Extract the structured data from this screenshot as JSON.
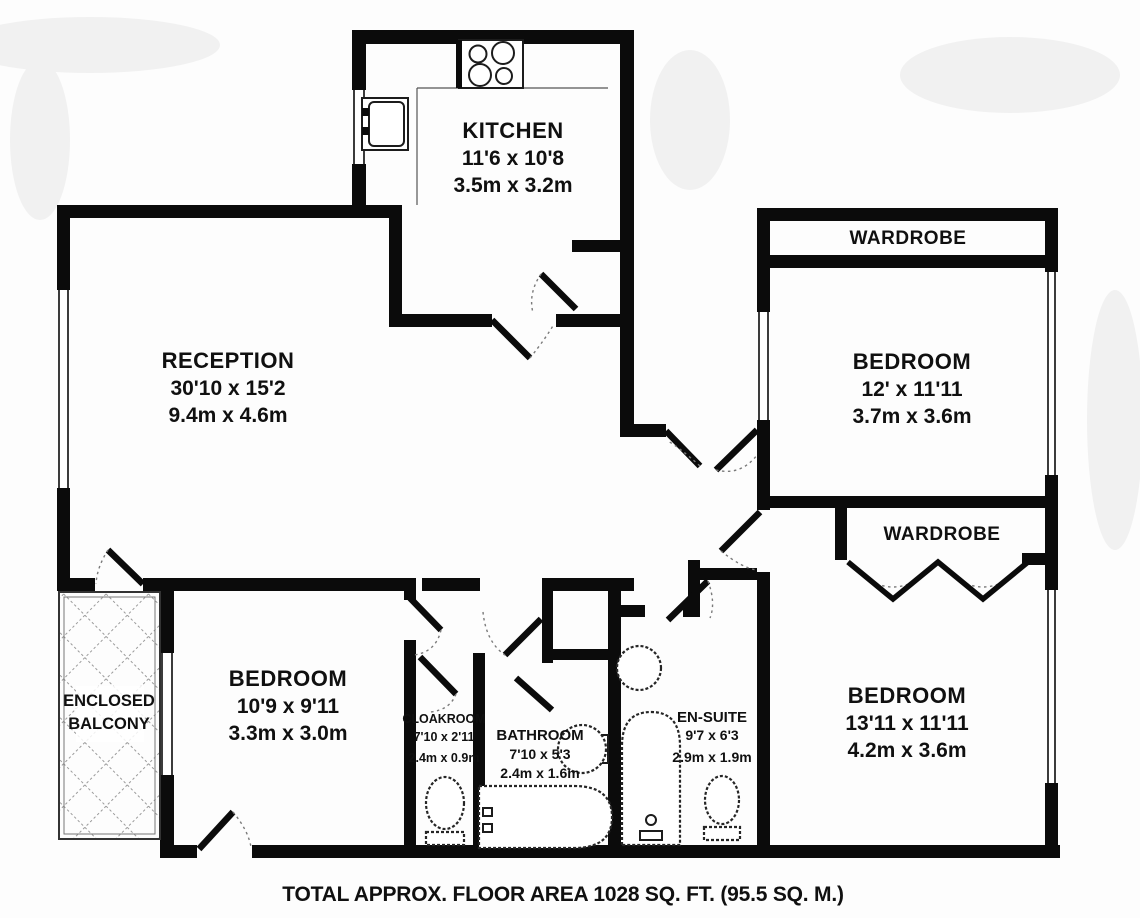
{
  "plan": {
    "caption": "TOTAL APPROX. FLOOR AREA 1028 SQ. FT. (95.5 SQ. M.)",
    "rooms": {
      "reception": {
        "name": "RECEPTION",
        "imperial": "30'10 x 15'2",
        "metric": "9.4m x 4.6m"
      },
      "kitchen": {
        "name": "KITCHEN",
        "imperial": "11'6 x 10'8",
        "metric": "3.5m x 3.2m"
      },
      "bedroom_top_right": {
        "name": "BEDROOM",
        "imperial": "12' x 11'11",
        "metric": "3.7m x 3.6m"
      },
      "bedroom_bottom_right": {
        "name": "BEDROOM",
        "imperial": "13'11 x 11'11",
        "metric": "4.2m x 3.6m"
      },
      "bedroom_bottom_left": {
        "name": "BEDROOM",
        "imperial": "10'9 x 9'11",
        "metric": "3.3m x 3.0m"
      },
      "bathroom": {
        "name": "BATHROOM",
        "imperial": "7'10 x 5'3",
        "metric": "2.4m x 1.6m"
      },
      "cloakroom": {
        "name": "CLOAKROOM",
        "imperial": "7'10 x 2'11",
        "metric": "2.4m x 0.9m"
      },
      "ensuite": {
        "name": "EN-SUITE",
        "imperial": "9'7 x 6'3",
        "metric": "2.9m x 1.9m"
      },
      "wardrobe_top": {
        "name": "WARDROBE"
      },
      "wardrobe_middle": {
        "name": "WARDROBE"
      },
      "balcony": {
        "name_line1": "ENCLOSED",
        "name_line2": "BALCONY"
      }
    },
    "colors": {
      "wall": "#0b0b0b",
      "background": "#fdfdfd",
      "hatch": "#9a9a9a",
      "text": "#101010"
    }
  }
}
